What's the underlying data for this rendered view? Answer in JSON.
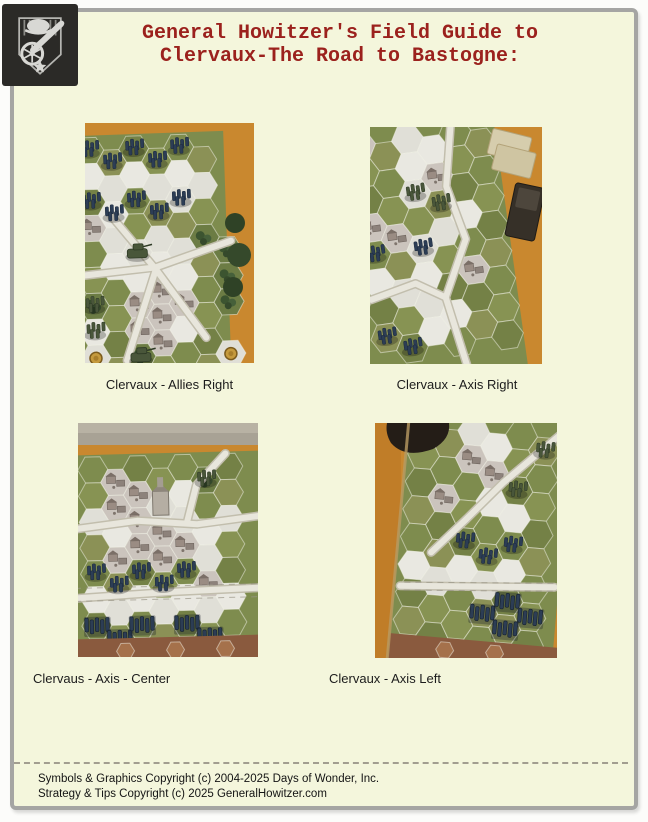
{
  "header": {
    "line1": "General Howitzer's Field Guide to",
    "line2": "Clervaux-The Road to Bastogne:"
  },
  "logo": {
    "name": "howitzer-cannon-badge"
  },
  "photos": [
    {
      "id": "allies-right",
      "caption": "Clervaux - Allies Right"
    },
    {
      "id": "axis-right",
      "caption": "Clervaux - Axis Right"
    },
    {
      "id": "axis-center",
      "caption": "Clervaus - Axis - Center"
    },
    {
      "id": "axis-left",
      "caption": "Clervaux - Axis Left"
    }
  ],
  "footer": {
    "line1": "Symbols & Graphics Copyright (c) 2004-2025 Days of Wonder, Inc.",
    "line2": "Strategy & Tips Copyright (c) 2025 GeneralHowitzer.com"
  },
  "palette": {
    "page_bg": "#fcfcfa",
    "panel_bg": "#f4f6dc",
    "panel_border": "#a5a5a3",
    "title_red": "#9b211d",
    "logo_bg": "#2b2a27",
    "table_orange": "#c9882f",
    "hex_green": "#7e8c4e",
    "hex_snow": "#e9e8e1",
    "village_gray": "#cbc4bd",
    "axis_unit_blue": "#2c3d55",
    "allies_unit_green": "#49563a",
    "board_edge_brown": "#8a5a3e"
  }
}
